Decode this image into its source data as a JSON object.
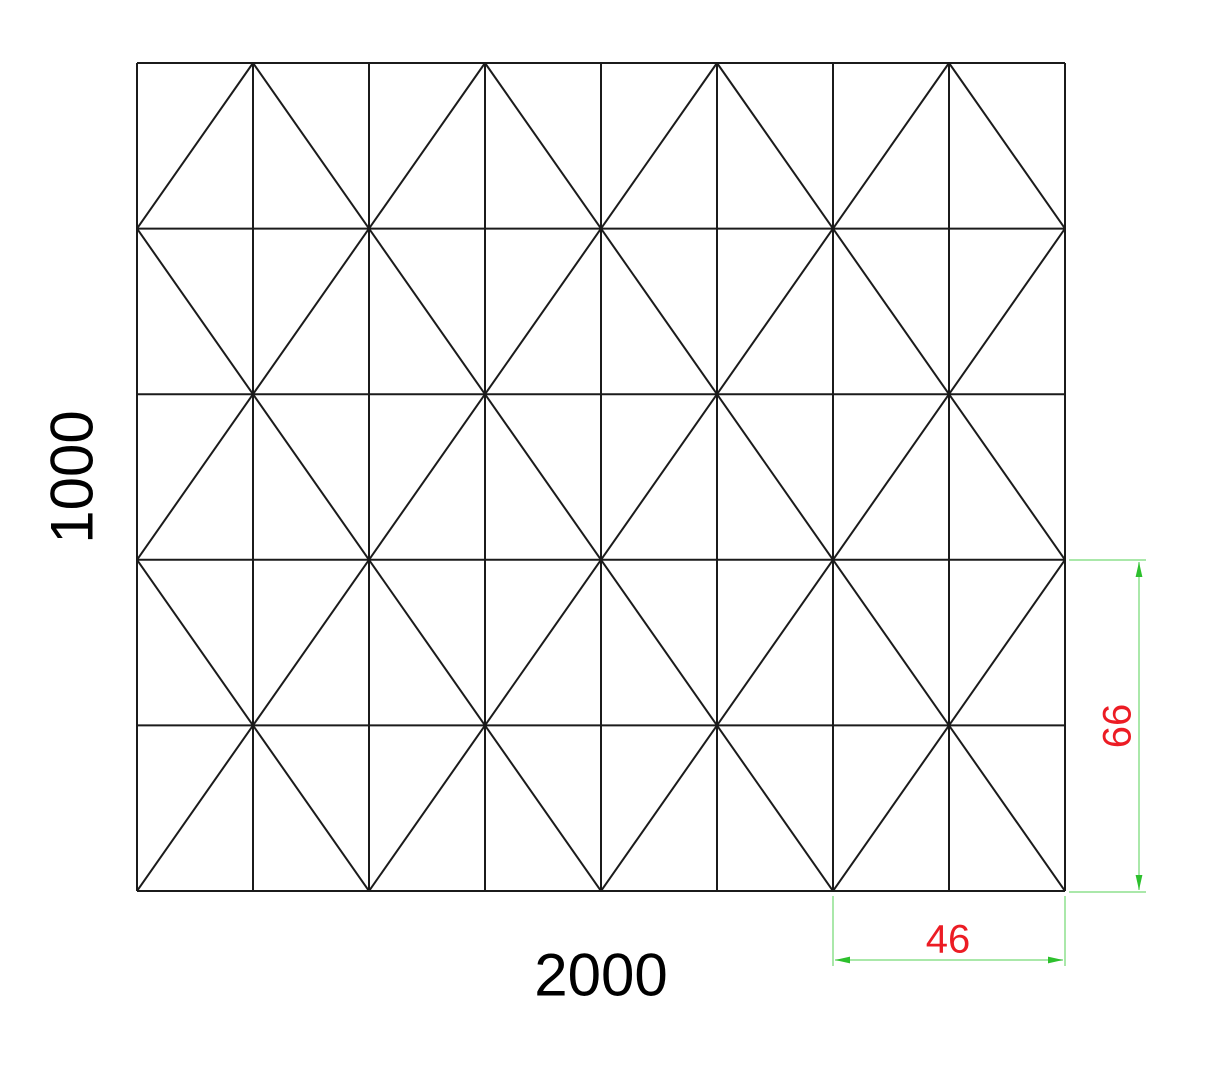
{
  "page": {
    "width": 1214,
    "height": 1066,
    "background": "#ffffff"
  },
  "drawing": {
    "kind": "triangulated-mesh-panel",
    "outline": {
      "left": 137,
      "top": 63,
      "right": 1065,
      "bottom": 891
    },
    "grid": {
      "columns": 8,
      "rows": 5
    },
    "diagonal_pattern": "checkerboard-alternating",
    "line_color": "#1b1b1b",
    "line_width": 2
  },
  "labels": {
    "overall_height": "1000",
    "overall_width": "2000",
    "color": "#000000",
    "font_size": 60,
    "height_label_center": {
      "x": 71,
      "y": 477
    },
    "width_label_center": {
      "x": 601,
      "y": 974
    }
  },
  "dimensions": {
    "line_color": "#8ee08e",
    "arrow_color": "#2dc02d",
    "text_color": "#ec1c24",
    "font_size": 40,
    "detail_height": {
      "label": "66",
      "ext_x_start": 1069,
      "ext_x_end": 1146,
      "ext_top_y": 560,
      "ext_bottom_y": 892,
      "line_x": 1139,
      "text_center": {
        "x": 1116,
        "y": 726
      }
    },
    "detail_width": {
      "label": "46",
      "ext_left_x": 833,
      "ext_right_x": 1065,
      "ext_y_start": 896,
      "ext_y_end": 966,
      "line_y": 960,
      "text_center": {
        "x": 948,
        "y": 938
      }
    }
  }
}
